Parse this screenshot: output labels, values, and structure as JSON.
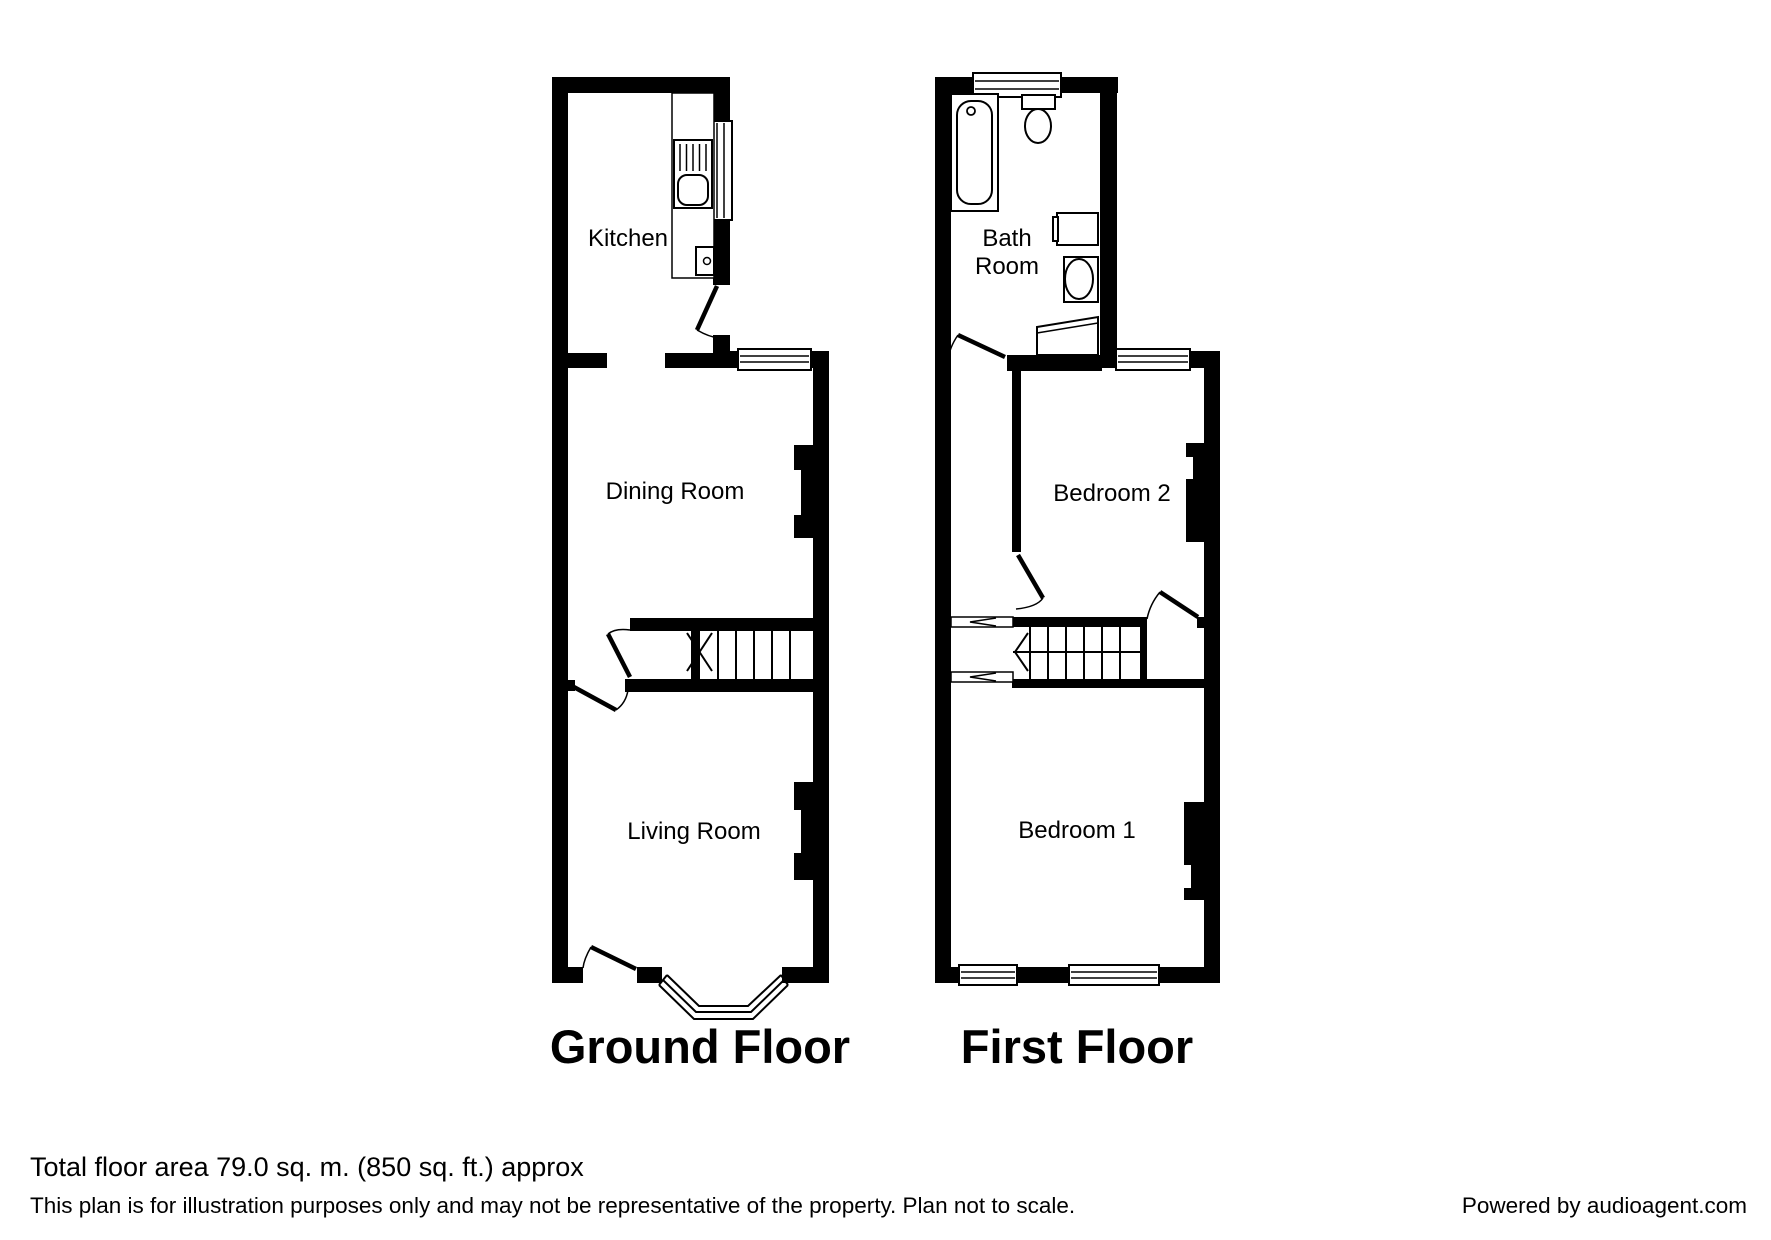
{
  "colors": {
    "ink": "#000000",
    "paper": "#ffffff"
  },
  "plans": {
    "ground": {
      "title": "Ground Floor",
      "rooms": {
        "kitchen": {
          "label": "Kitchen"
        },
        "dining": {
          "label": "Dining Room"
        },
        "living": {
          "label": "Living Room"
        }
      }
    },
    "first": {
      "title": "First Floor",
      "rooms": {
        "bathroom": {
          "lines": [
            "Bath",
            "Room"
          ]
        },
        "bedroom2": {
          "label": "Bedroom 2"
        },
        "bedroom1": {
          "label": "Bedroom 1"
        }
      }
    }
  },
  "footer": {
    "area": "Total floor area 79.0 sq. m. (850 sq. ft.) approx",
    "disclaimer": "This plan is for illustration purposes only and may not be representative of the property. Plan not to scale.",
    "credit": "Powered by audioagent.com"
  }
}
